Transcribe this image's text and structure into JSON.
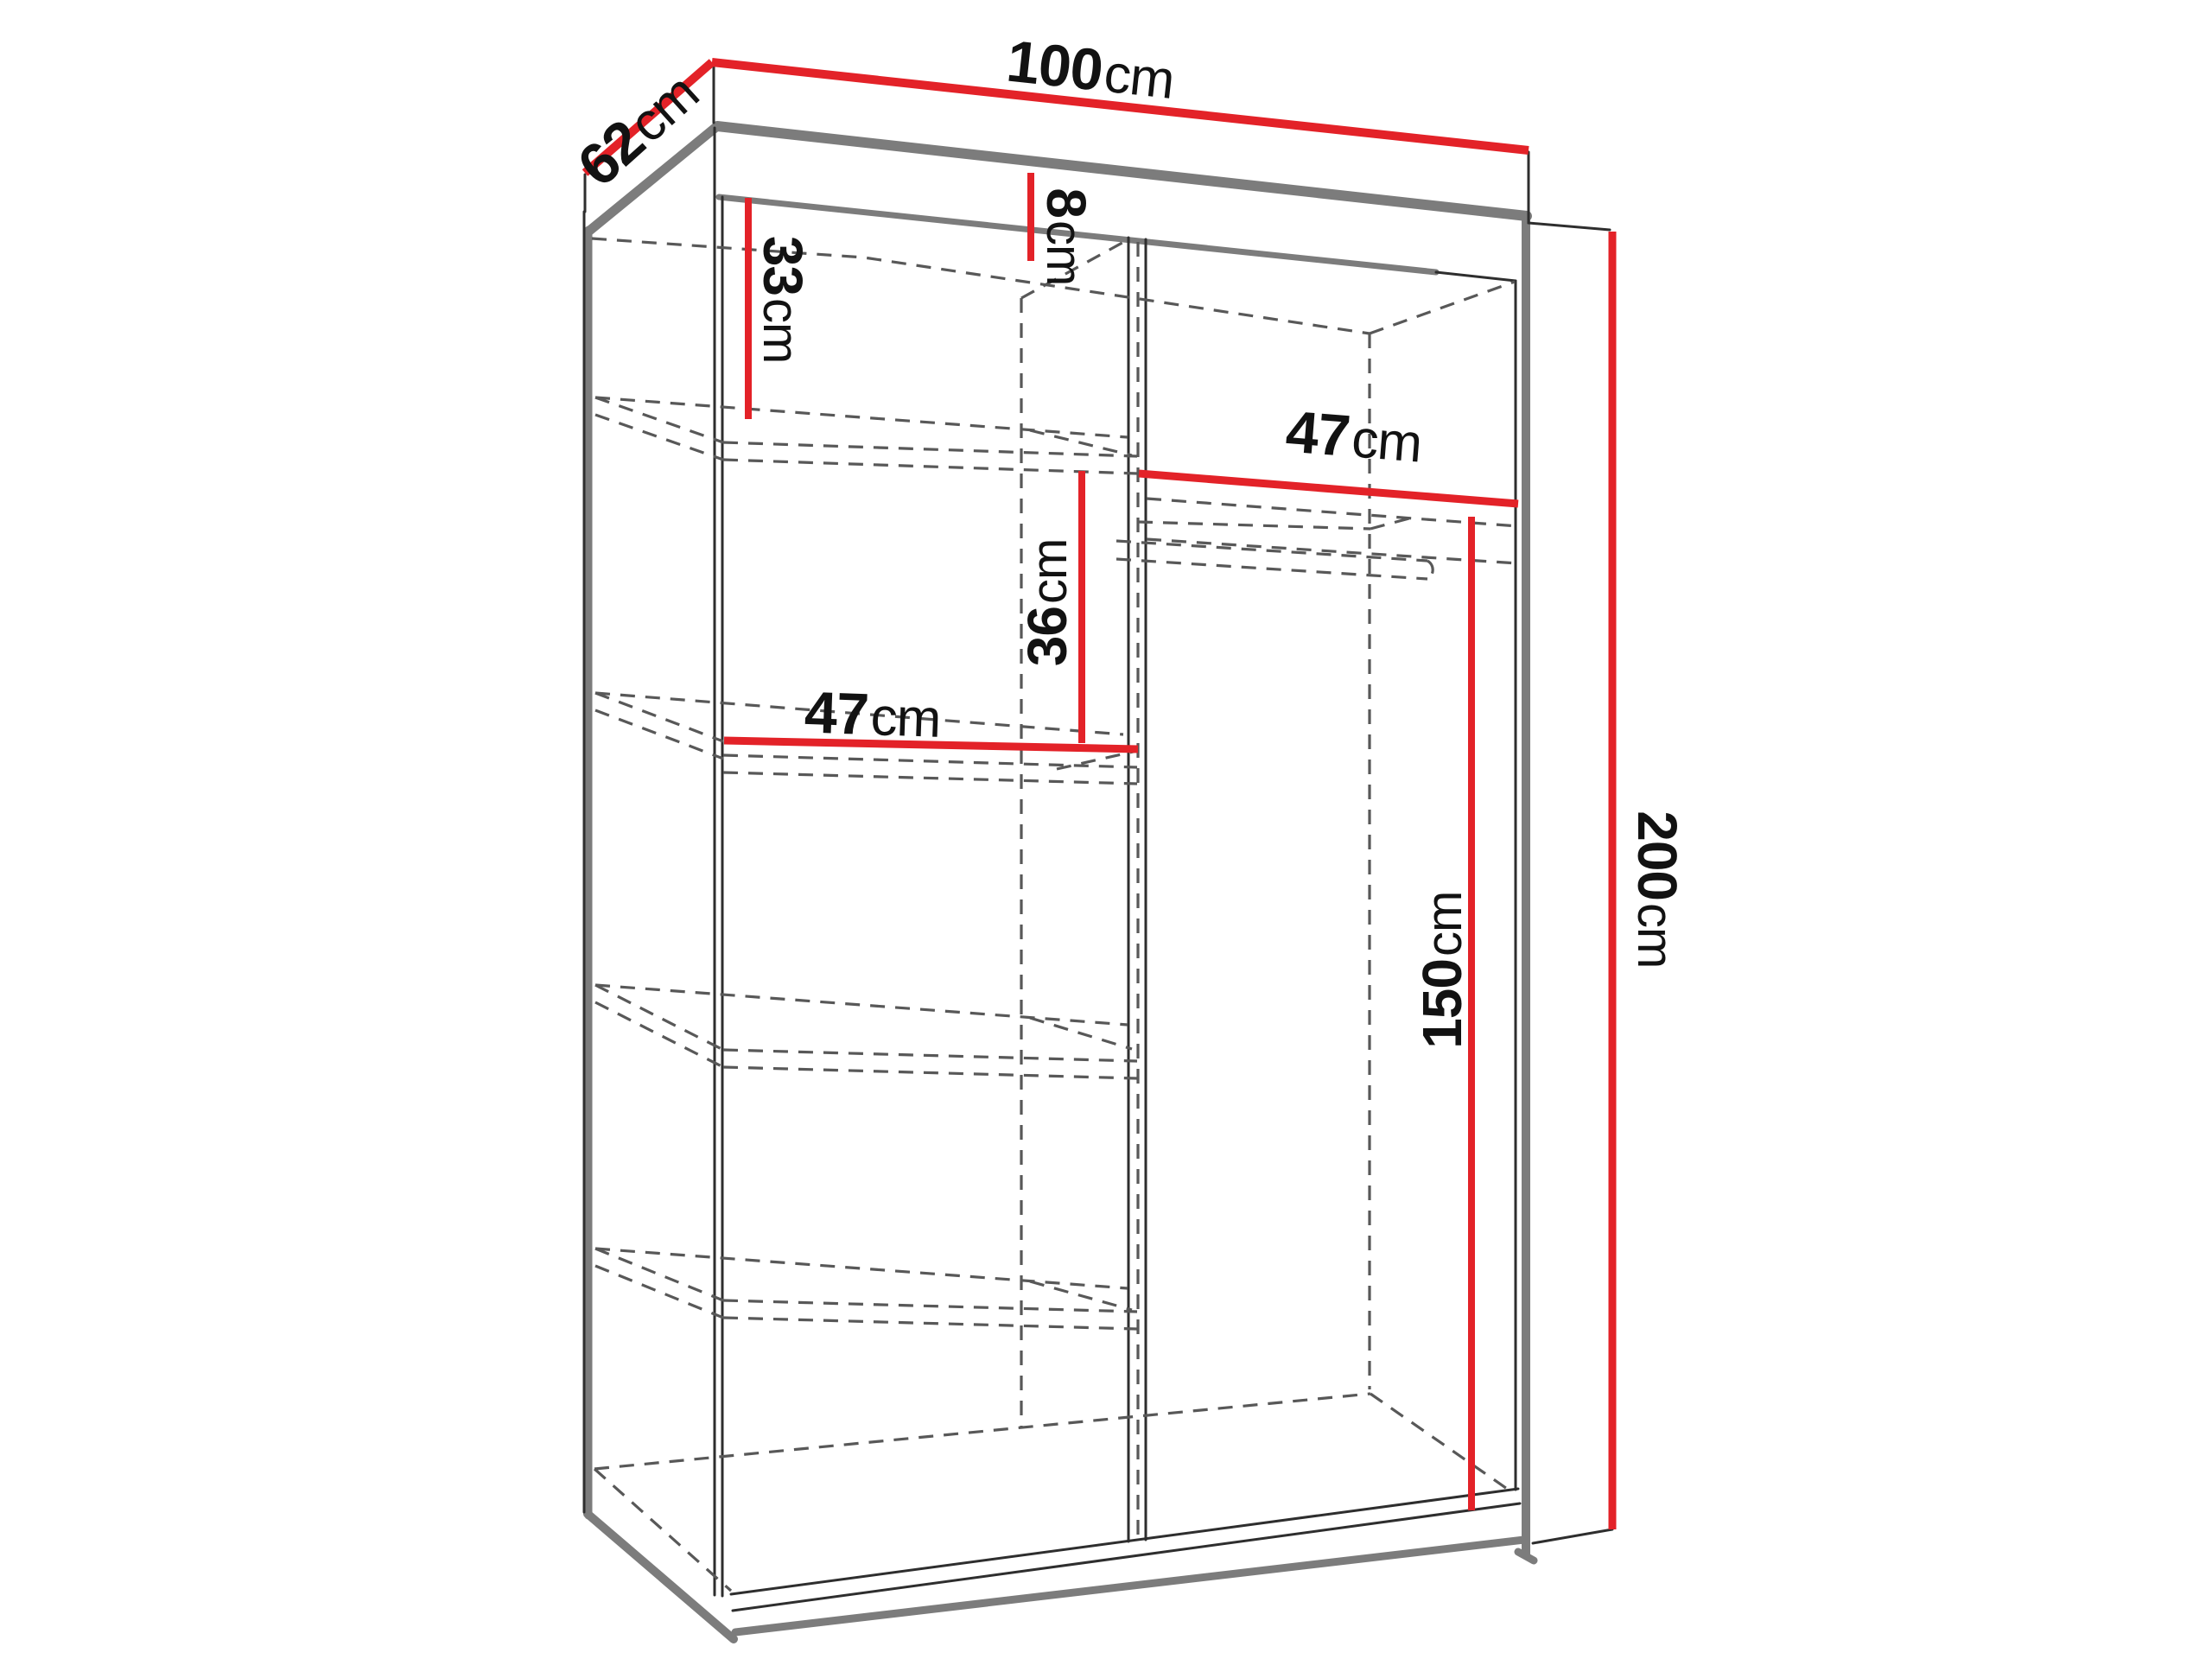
{
  "diagram": {
    "kind": "wardrobe-dimension-diagram",
    "unit": "cm",
    "labels": {
      "width": {
        "value": "100",
        "unit": "cm"
      },
      "depth": {
        "value": "62",
        "unit": "cm"
      },
      "top_clearance": {
        "value": "8",
        "unit": "cm"
      },
      "upper_shelf_gap": {
        "value": "33",
        "unit": "cm"
      },
      "left_shelf_width": {
        "value": "47",
        "unit": "cm"
      },
      "middle_gap": {
        "value": "36",
        "unit": "cm"
      },
      "right_shelf_width": {
        "value": "47",
        "unit": "cm"
      },
      "hanging_height": {
        "value": "150",
        "unit": "cm"
      },
      "total_height": {
        "value": "200",
        "unit": "cm"
      }
    },
    "colors": {
      "dimension_line": "#e32228",
      "outline": "#2e2e2e",
      "edge_gray": "#7c7c7c",
      "dashed_line": "#585858",
      "text": "#121212",
      "background": "#ffffff"
    }
  }
}
